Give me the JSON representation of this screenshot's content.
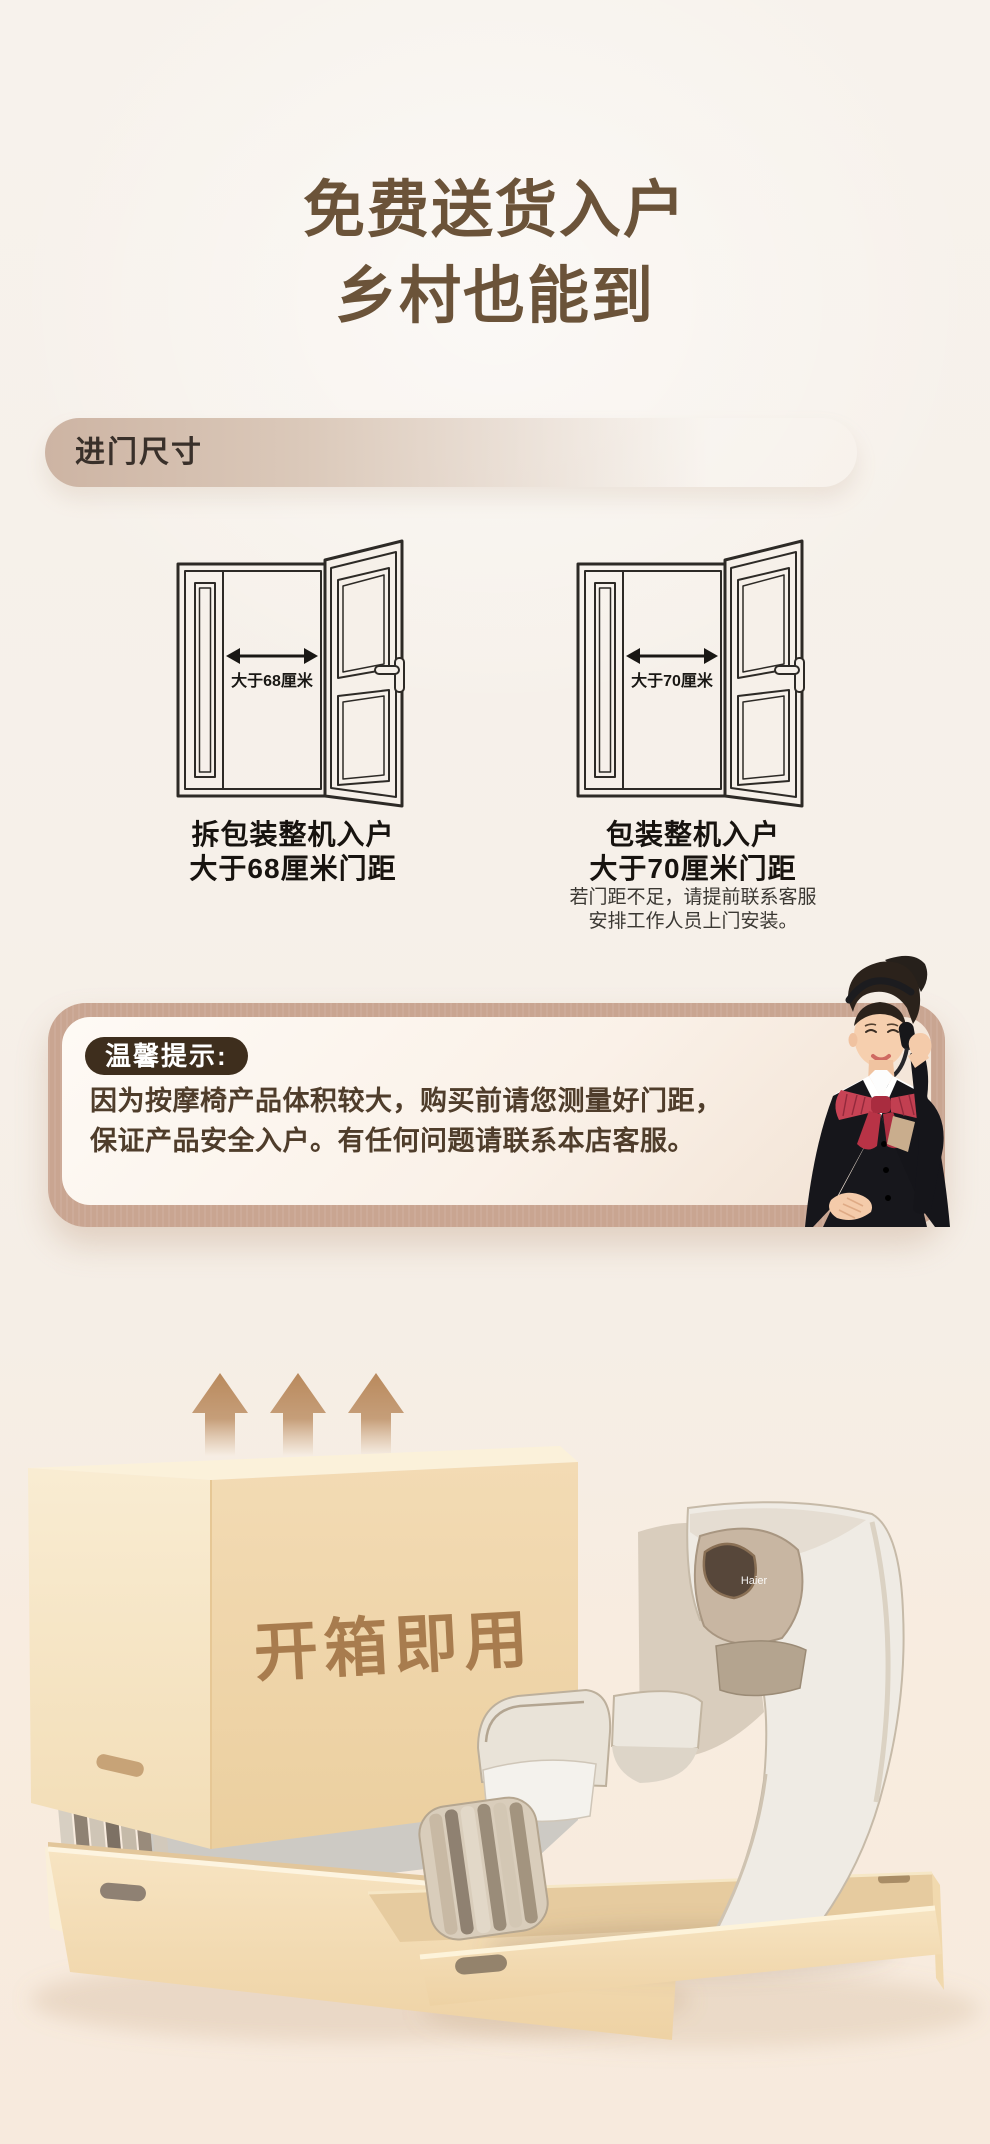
{
  "header": {
    "title_line1": "免费送货入户",
    "title_line2": "乡村也能到"
  },
  "section": {
    "badge": "进门尺寸"
  },
  "doors": [
    {
      "measure": "大于68厘米",
      "caption_line1": "拆包装整机入户",
      "caption_line2": "大于68厘米门距"
    },
    {
      "measure": "大于70厘米",
      "caption_line1": "包装整机入户",
      "caption_line2": "大于70厘米门距",
      "note_line1": "若门距不足，请提前联系客服",
      "note_line2": "安排工作人员上门安装。"
    }
  ],
  "tip": {
    "label": "温馨提示:",
    "body_line1": "因为按摩椅产品体积较大，购买前请您测量好门距，",
    "body_line2": "保证产品安全入户。有任何问题请联系本店客服。"
  },
  "unboxing": {
    "box_text": "开箱即用",
    "chair_logo": "Haier"
  },
  "colors": {
    "title_brown": "#6b5339",
    "badge_gradient_start": "#cdb4a3",
    "tip_frame": "#c9a591",
    "tip_pill": "#3e2e1d",
    "tip_text": "#4f3d2b",
    "arrow_brown": "#b9895c",
    "box_front": "#f1d7ad",
    "box_text_brown": "#a87c4e",
    "chair_cream": "#efebe4"
  }
}
